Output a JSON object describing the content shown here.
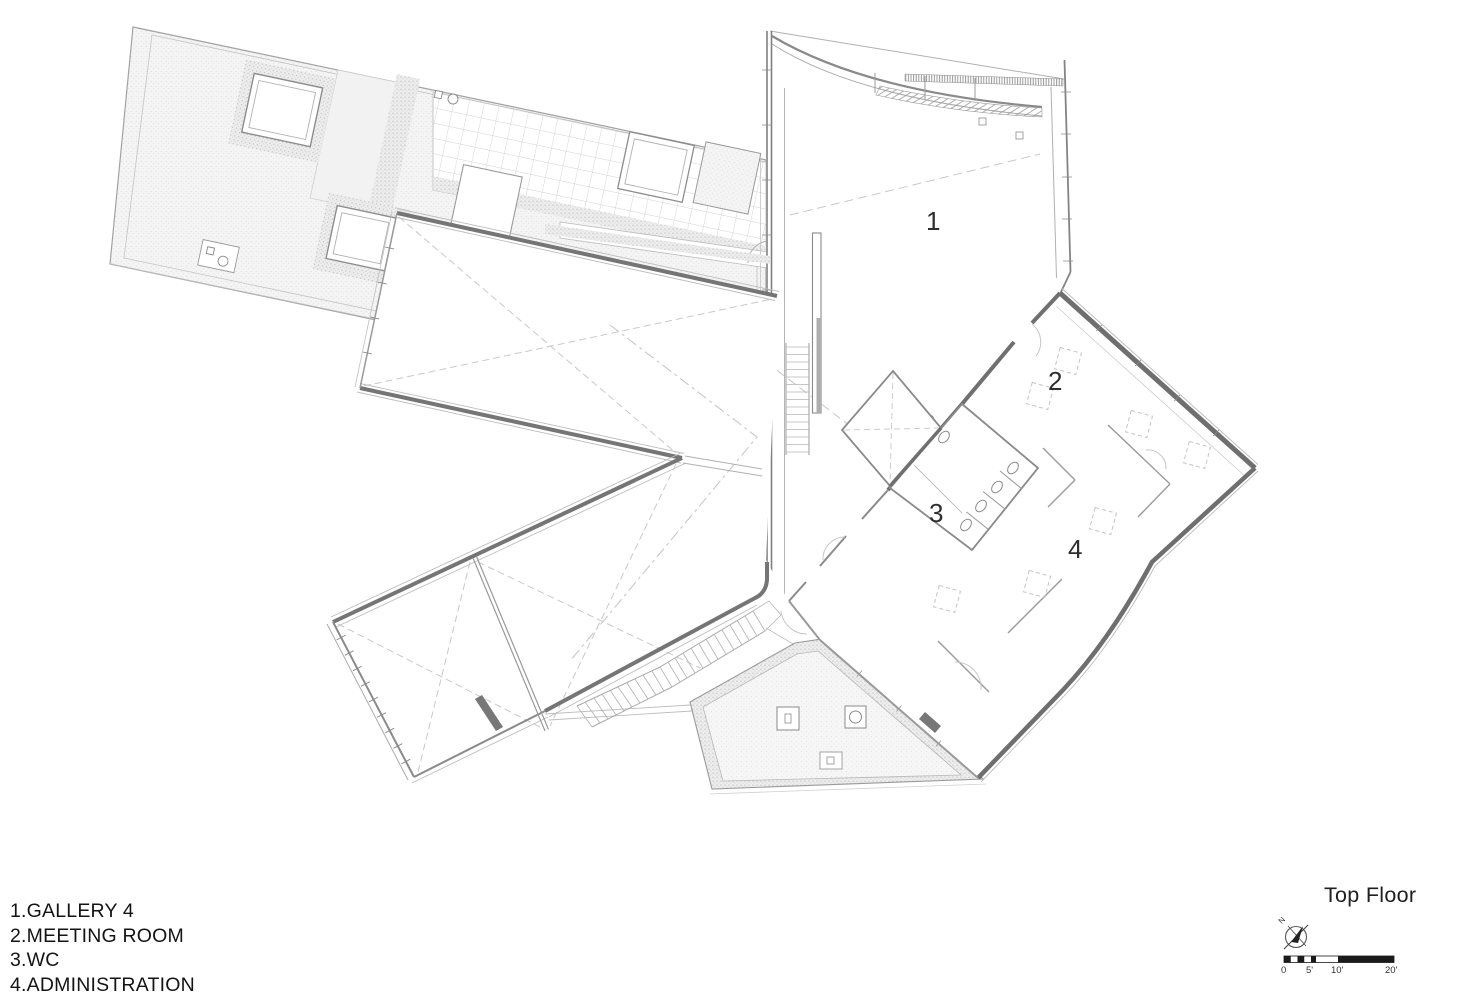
{
  "drawing": {
    "title": "Top Floor",
    "legend": [
      "1.GALLERY 4",
      "2.MEETING ROOM",
      "3.WC",
      "4.ADMINISTRATION"
    ],
    "rooms": [
      {
        "number": "1",
        "name": "GALLERY 4"
      },
      {
        "number": "2",
        "name": "MEETING ROOM"
      },
      {
        "number": "3",
        "name": "WC"
      },
      {
        "number": "4",
        "name": "ADMINISTRATION"
      }
    ],
    "north_label": "N",
    "scale_labels": [
      "0",
      "5'",
      "10'",
      "20'"
    ],
    "colors": {
      "wall_dark": "#6f6f6f",
      "line_mid": "#9a9a9a",
      "line_light": "#c6c6c6",
      "stipple_dot": "#d0d0d0",
      "paper": "#ffffff",
      "text": "#1a1a1a"
    }
  }
}
